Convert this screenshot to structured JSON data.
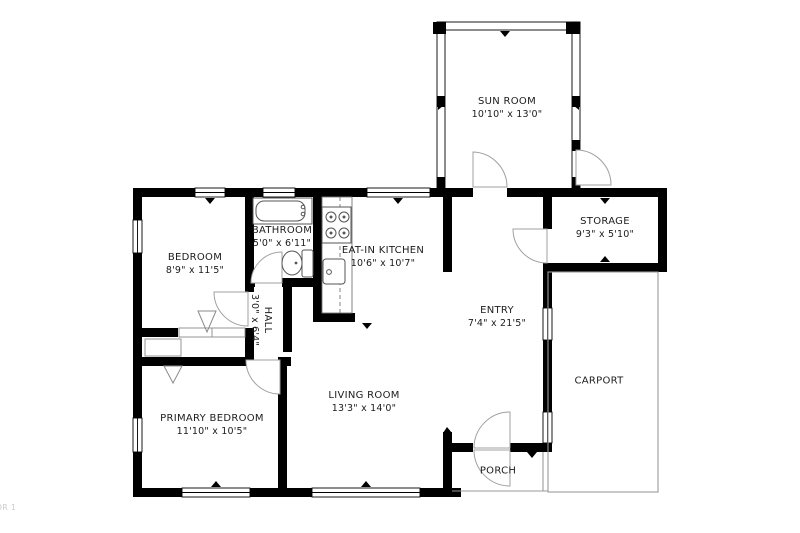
{
  "meta": {
    "watermark": "OR 1",
    "floorplan_type": "single-story house floor plan"
  },
  "colors": {
    "wall": "#000000",
    "background": "#ffffff",
    "door_arc": "#a0a0a0",
    "fixture_outline": "#555555",
    "open_structure_outline": "#9a9a9a",
    "label_text": "#1c1c1c",
    "watermark_text": "#c9c9c9"
  },
  "rooms": [
    {
      "id": "sun-room",
      "name": "SUN ROOM",
      "dims": "10'10\" x 13'0\""
    },
    {
      "id": "storage",
      "name": "STORAGE",
      "dims": "9'3\" x 5'10\""
    },
    {
      "id": "bedroom",
      "name": "BEDROOM",
      "dims": "8'9\" x 11'5\""
    },
    {
      "id": "bathroom",
      "name": "BATHROOM",
      "dims": "5'0\" x 6'11\""
    },
    {
      "id": "eat-in-kitchen",
      "name": "EAT-IN KITCHEN",
      "dims": "10'6\" x 10'7\""
    },
    {
      "id": "entry",
      "name": "ENTRY",
      "dims": "7'4\" x 21'5\""
    },
    {
      "id": "hall",
      "name": "HALL",
      "dims": "3'0\" x 6'4\""
    },
    {
      "id": "living-room",
      "name": "LIVING ROOM",
      "dims": "13'3\" x 14'0\""
    },
    {
      "id": "primary-bedroom",
      "name": "PRIMARY BEDROOM",
      "dims": "11'10\" x 10'5\""
    },
    {
      "id": "carport",
      "name": "CARPORT",
      "dims": ""
    },
    {
      "id": "porch",
      "name": "PORCH",
      "dims": ""
    }
  ],
  "fixtures": [
    "bathtub",
    "toilet",
    "stove",
    "kitchen-sink",
    "kitchen-counter",
    "closet-rod-markers"
  ]
}
